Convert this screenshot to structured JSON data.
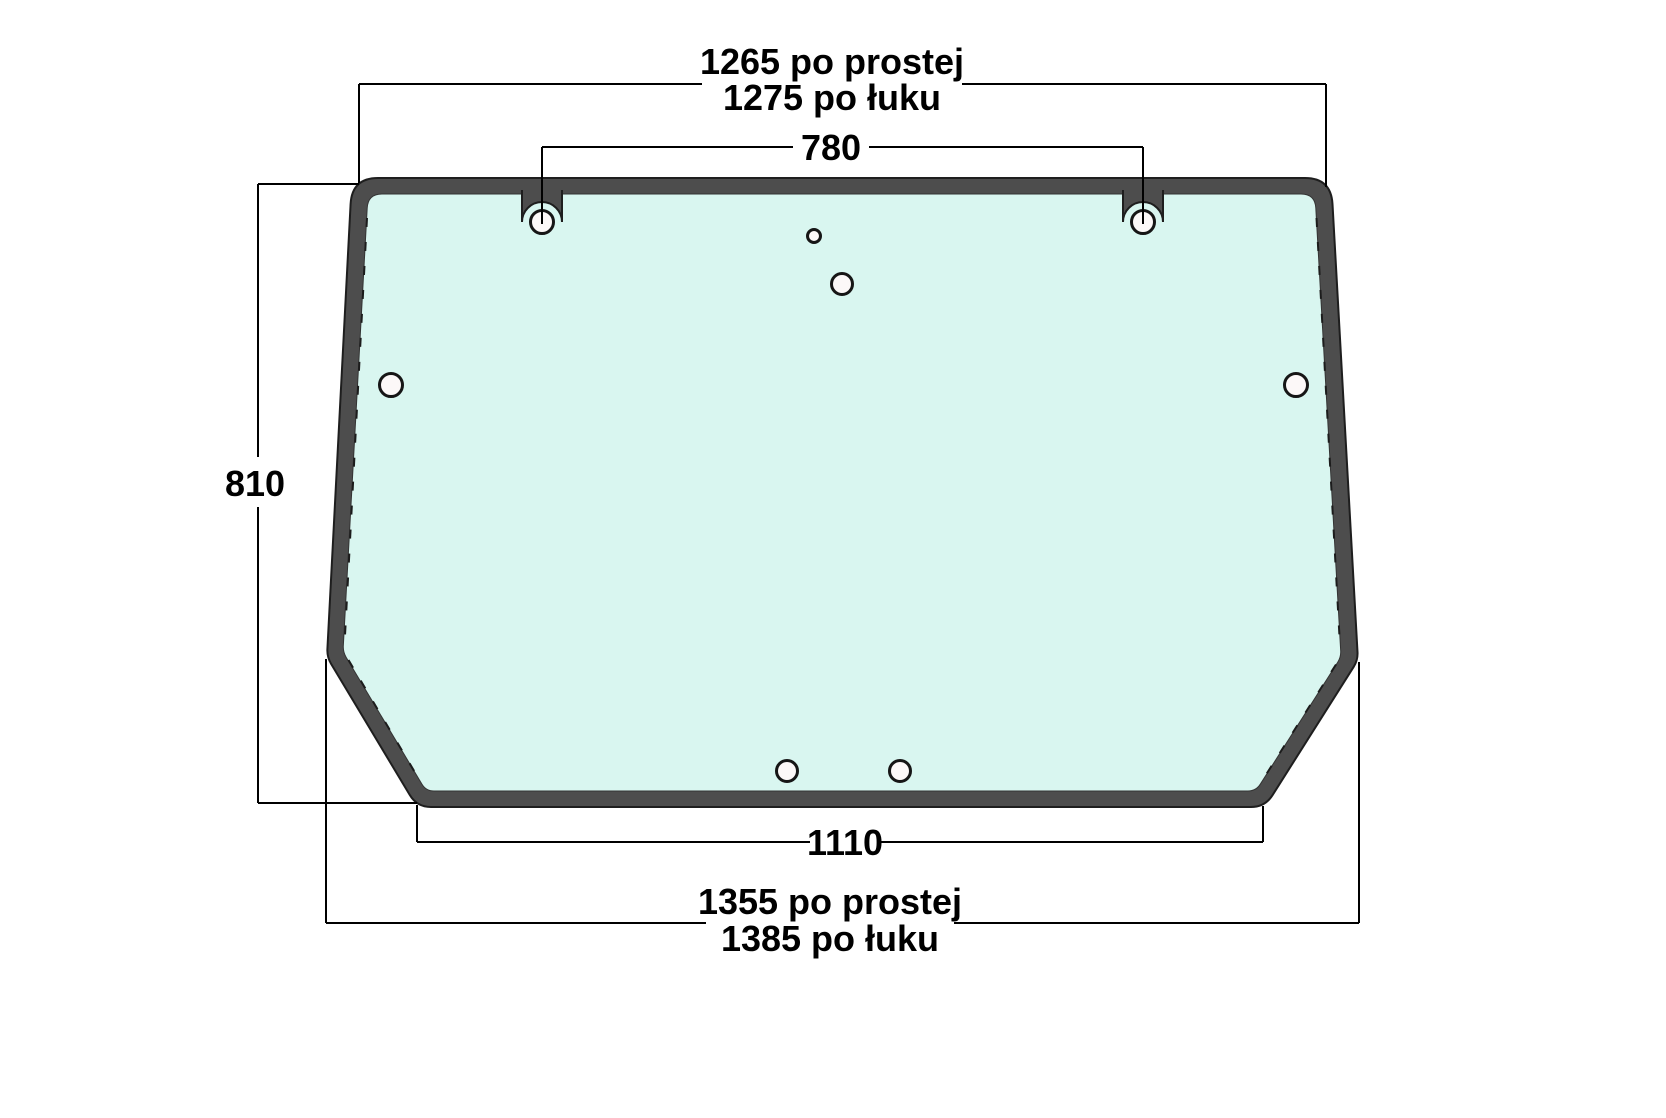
{
  "drawing": {
    "kind": "glass panel technical drawing",
    "dimensions": {
      "top_width_straight": "1265 po prostej",
      "top_width_arc": "1275 po łuku",
      "top_holes_spacing": "780",
      "height": "810",
      "bottom_edge_width": "1110",
      "bottom_width_straight": "1355 po prostej",
      "bottom_width_arc": "1385 po łuku"
    }
  },
  "colors": {
    "frame": "#4d4d4d",
    "frame_outline": "#1e1e1e",
    "glass": "#d9f6f0",
    "hole_fill": "#fcf8f8",
    "hole_outline": "#161616",
    "dimension_line": "#000000",
    "background": "#ffffff"
  }
}
